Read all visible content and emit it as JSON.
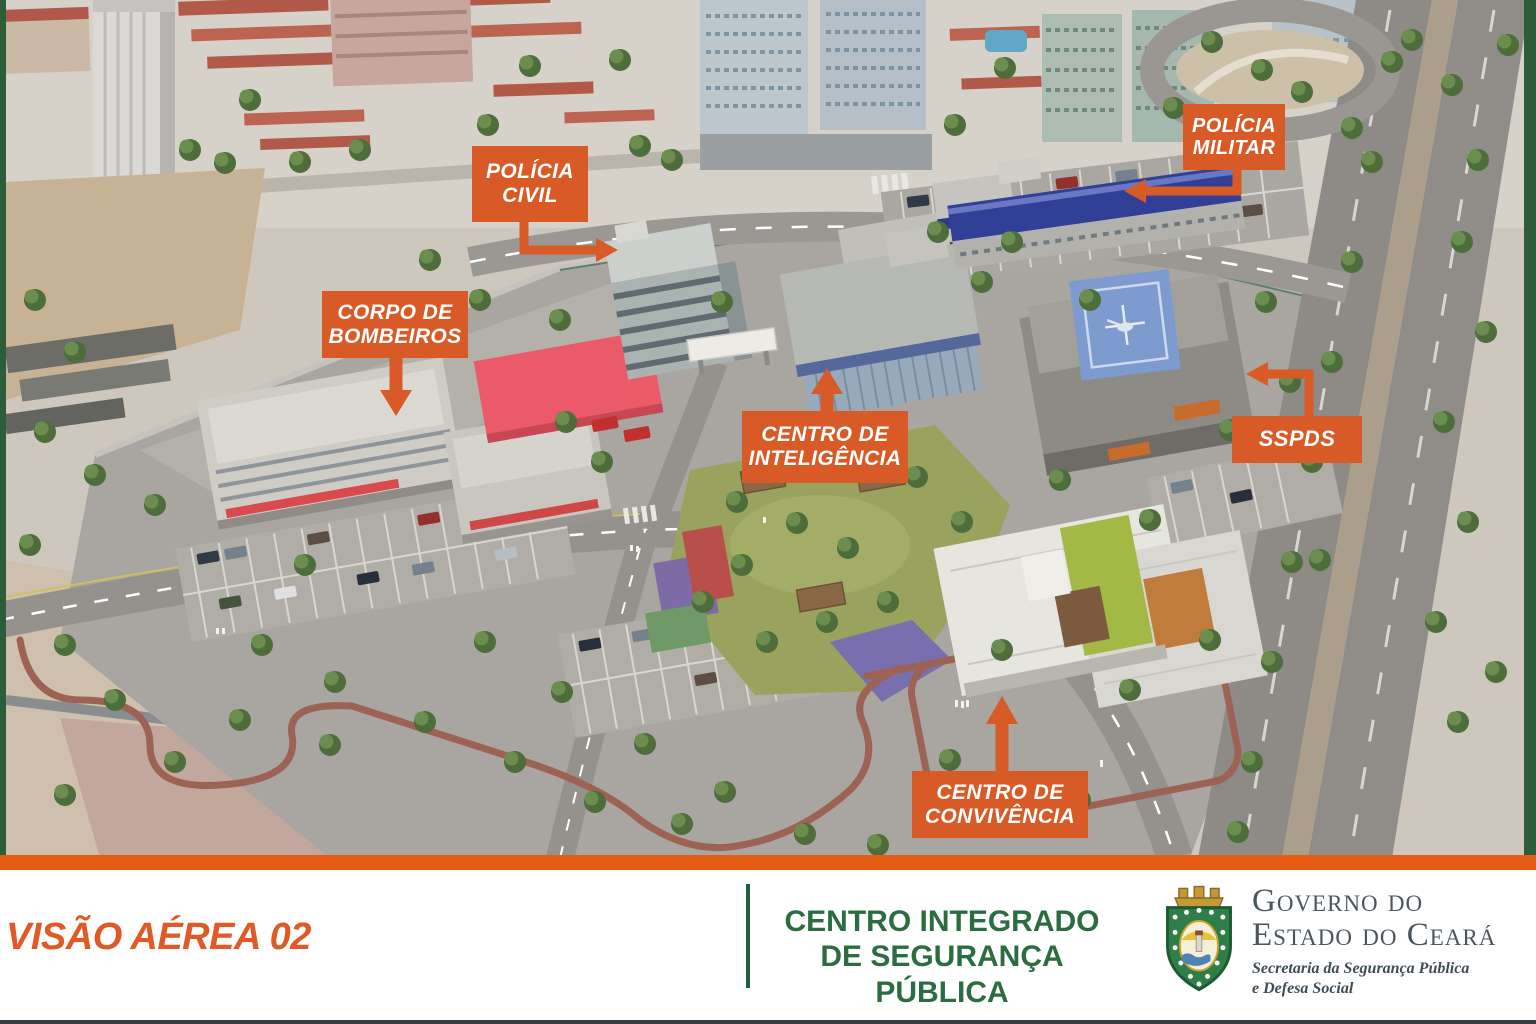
{
  "meta": {
    "slide_name": "Visão Aérea 02 — Centro Integrado de Segurança Pública"
  },
  "colors": {
    "callout_orange": "#d85a27",
    "bar_orange": "#e55c15",
    "edge_green": "#2c5c38",
    "title_green": "#2b6c41",
    "government_slate": "#4a565c"
  },
  "callouts": [
    {
      "id": "policia-civil",
      "label": "POLÍCIA\nCIVIL"
    },
    {
      "id": "policia-militar",
      "label": "POLÍCIA\nMILITAR"
    },
    {
      "id": "corpo-de-bombeiros",
      "label": "CORPO DE\nBOMBEIROS"
    },
    {
      "id": "centro-de-inteligencia",
      "label": "CENTRO DE\nINTELIGÊNCIA"
    },
    {
      "id": "sspds",
      "label": "SSPDS"
    },
    {
      "id": "centro-de-convivencia",
      "label": "CENTRO DE\nCONVIVÊNCIA"
    }
  ],
  "footer": {
    "view_label": "VISÃO AÉREA 02",
    "project_title": "CENTRO INTEGRADO\nDE SEGURANÇA PÚBLICA",
    "government": {
      "line1": "Governo do",
      "line2": "Estado do Ceará",
      "secretariat": "Secretaria da Segurança Pública\ne Defesa Social",
      "logo_icon": "ceara-coat-of-arms-icon"
    }
  }
}
